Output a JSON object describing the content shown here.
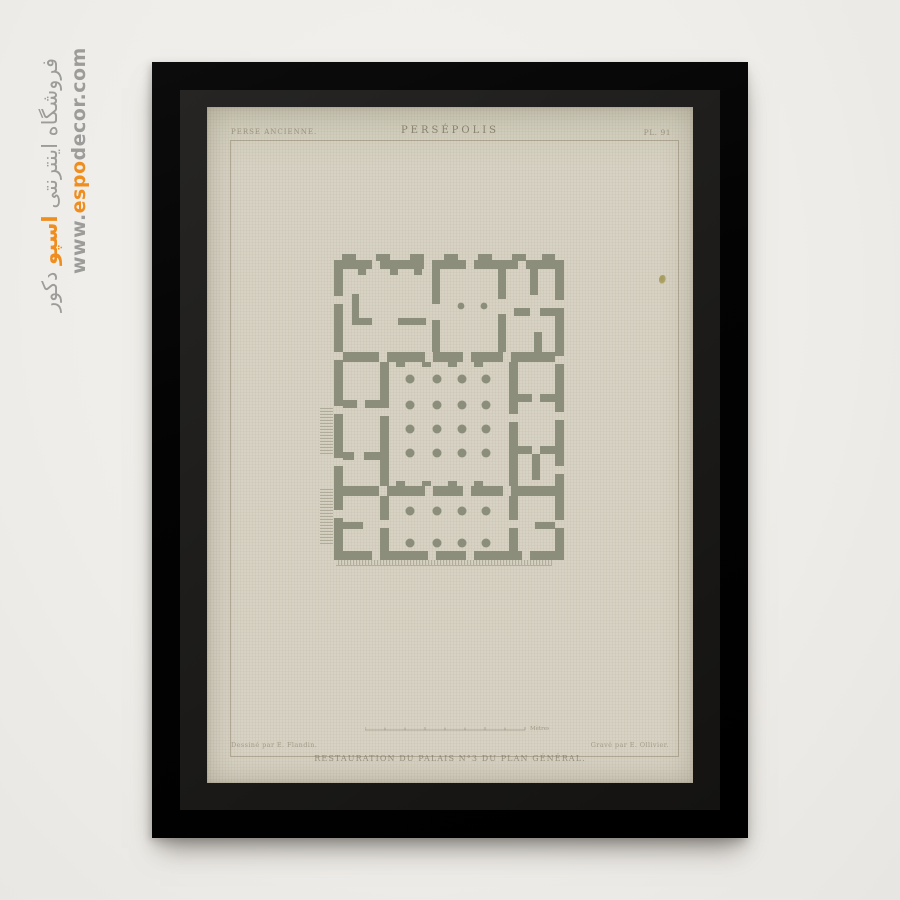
{
  "watermark": {
    "farsi_prefix": "فروشگاه اینترنتی",
    "farsi_highlight": "اسپو",
    "farsi_suffix": "دکور",
    "url_prefix": "www.",
    "url_highlight": "espo",
    "url_suffix": "decor.com",
    "gray_color": "#9c9c9a",
    "orange_color": "#ef8e1e"
  },
  "print": {
    "series_label": "PERSE ANCIENNE.",
    "title": "PERSÉPOLIS",
    "plate_number": "PL. 91",
    "caption": "RESTAURATION DU PALAIS N°3 DU PLAN GÉNÉRAL.",
    "credit_left": "Dessiné par E. Flandin.",
    "credit_right": "Gravé par E. Ollivier.",
    "scale_label": "Mètres.",
    "subject": "Persepolis palace floor plan engraving"
  },
  "colors": {
    "background": "#efede9",
    "frame": "#030303",
    "mat": "#1c1b19",
    "paper": "#d7d2c3",
    "plan_wall": "#898c79",
    "accent_orange": "#ef8e1e"
  }
}
